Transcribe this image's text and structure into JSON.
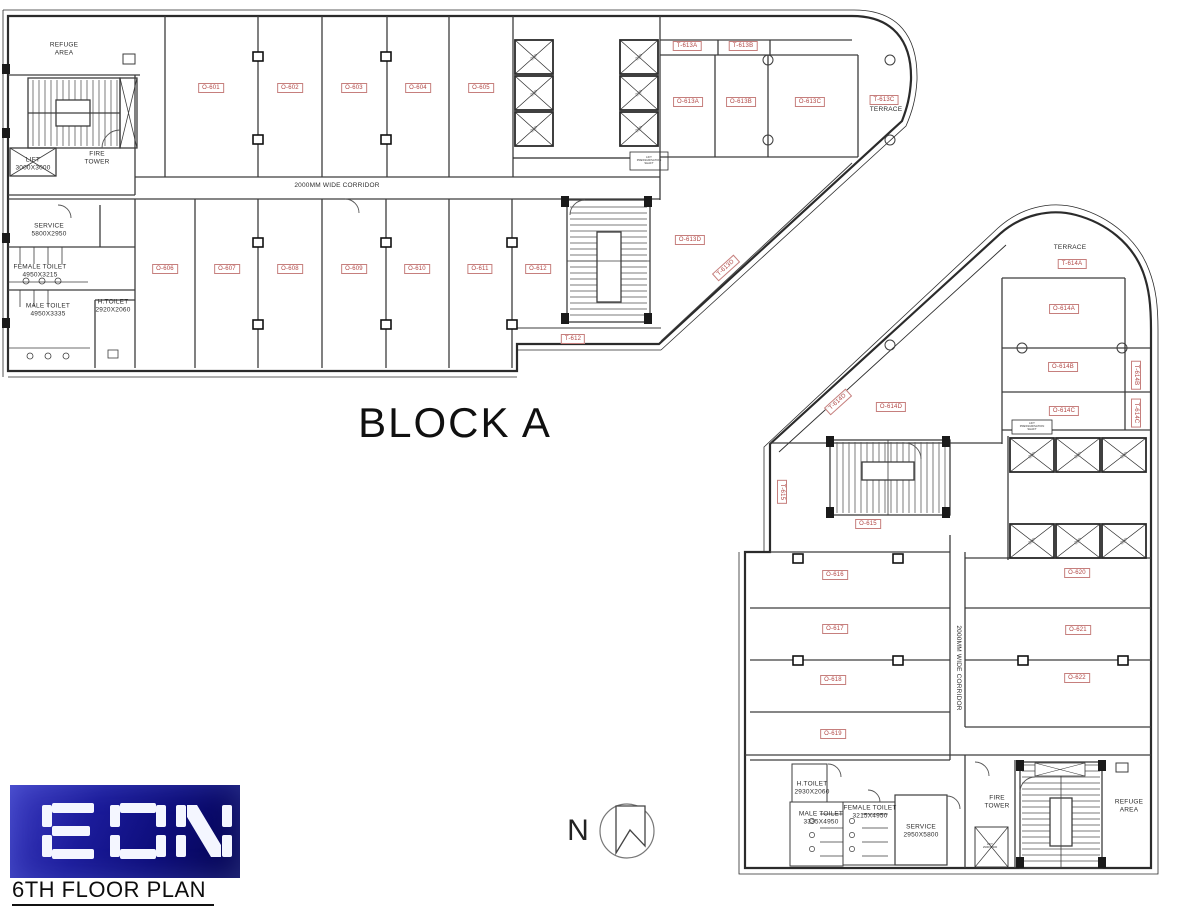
{
  "colors": {
    "wall": "#2e2e2e",
    "room_label_red": "#b04543",
    "logo_blue_start": "#3d3dc2",
    "logo_blue_end": "#05054e"
  },
  "title_block": {
    "logo": "EON",
    "plan_title": "6TH FLOOR PLAN"
  },
  "north_label": "N",
  "block_a": {
    "name": "BLOCK A",
    "corridor": "2000MM WIDE CORRIDOR",
    "refuge_area": "REFUGE\nAREA",
    "fire_tower": "FIRE\nTOWER",
    "lift": "LIFT\n3000X3000",
    "service": "SERVICE\n5800X2950",
    "female_toilet": "FEMALE TOILET\n4950X3215",
    "male_toilet": "MALE TOILET\n4950X3335",
    "h_toilet": "H.TOILET\n2920X2060",
    "lift_note": "LIFT\nPRESSURISATION\nSHAFT",
    "lift_capacity": "26P",
    "terrace": "TERRACE",
    "rooms_top": [
      "O-601",
      "O-602",
      "O-603",
      "O-604",
      "O-605"
    ],
    "rooms_mid": [
      "O-606",
      "O-607",
      "O-608",
      "O-609",
      "O-610",
      "O-611",
      "O-612"
    ],
    "rooms_613": [
      "O-613A",
      "O-613B",
      "O-613C",
      "O-613D"
    ],
    "terraces_613": [
      "T-613A",
      "T-613B",
      "T-613C",
      "T-613D"
    ],
    "terrace_612": "T-612"
  },
  "block_b": {
    "terrace": "TERRACE",
    "corridor": "2000MM WIDE CORRIDOR",
    "lift_capacity": "20P",
    "lift_note": "LIFT\nPRESSURISATION\nSHAFT",
    "rooms_614": [
      "O-614A",
      "O-614B",
      "O-614C",
      "O-614D"
    ],
    "terraces_614": [
      "T-614A",
      "T-614B",
      "T-614C",
      "T-614D"
    ],
    "terrace_615": "T-615",
    "room_615": "O-615",
    "rooms_left": [
      "O-616",
      "O-617",
      "O-618",
      "O-619"
    ],
    "rooms_right": [
      "O-620",
      "O-621",
      "O-622"
    ],
    "h_toilet": "H.TOILET\n2930X2060",
    "male_toilet": "MALE TOILET\n3335X4950",
    "female_toilet": "FEMALE TOILET\n3215X4950",
    "service": "SERVICE\n2950X5800",
    "fire_tower": "FIRE\nTOWER",
    "refuge_area": "REFUGE\nAREA",
    "lift_small": "LIFT\n2900X2900"
  }
}
